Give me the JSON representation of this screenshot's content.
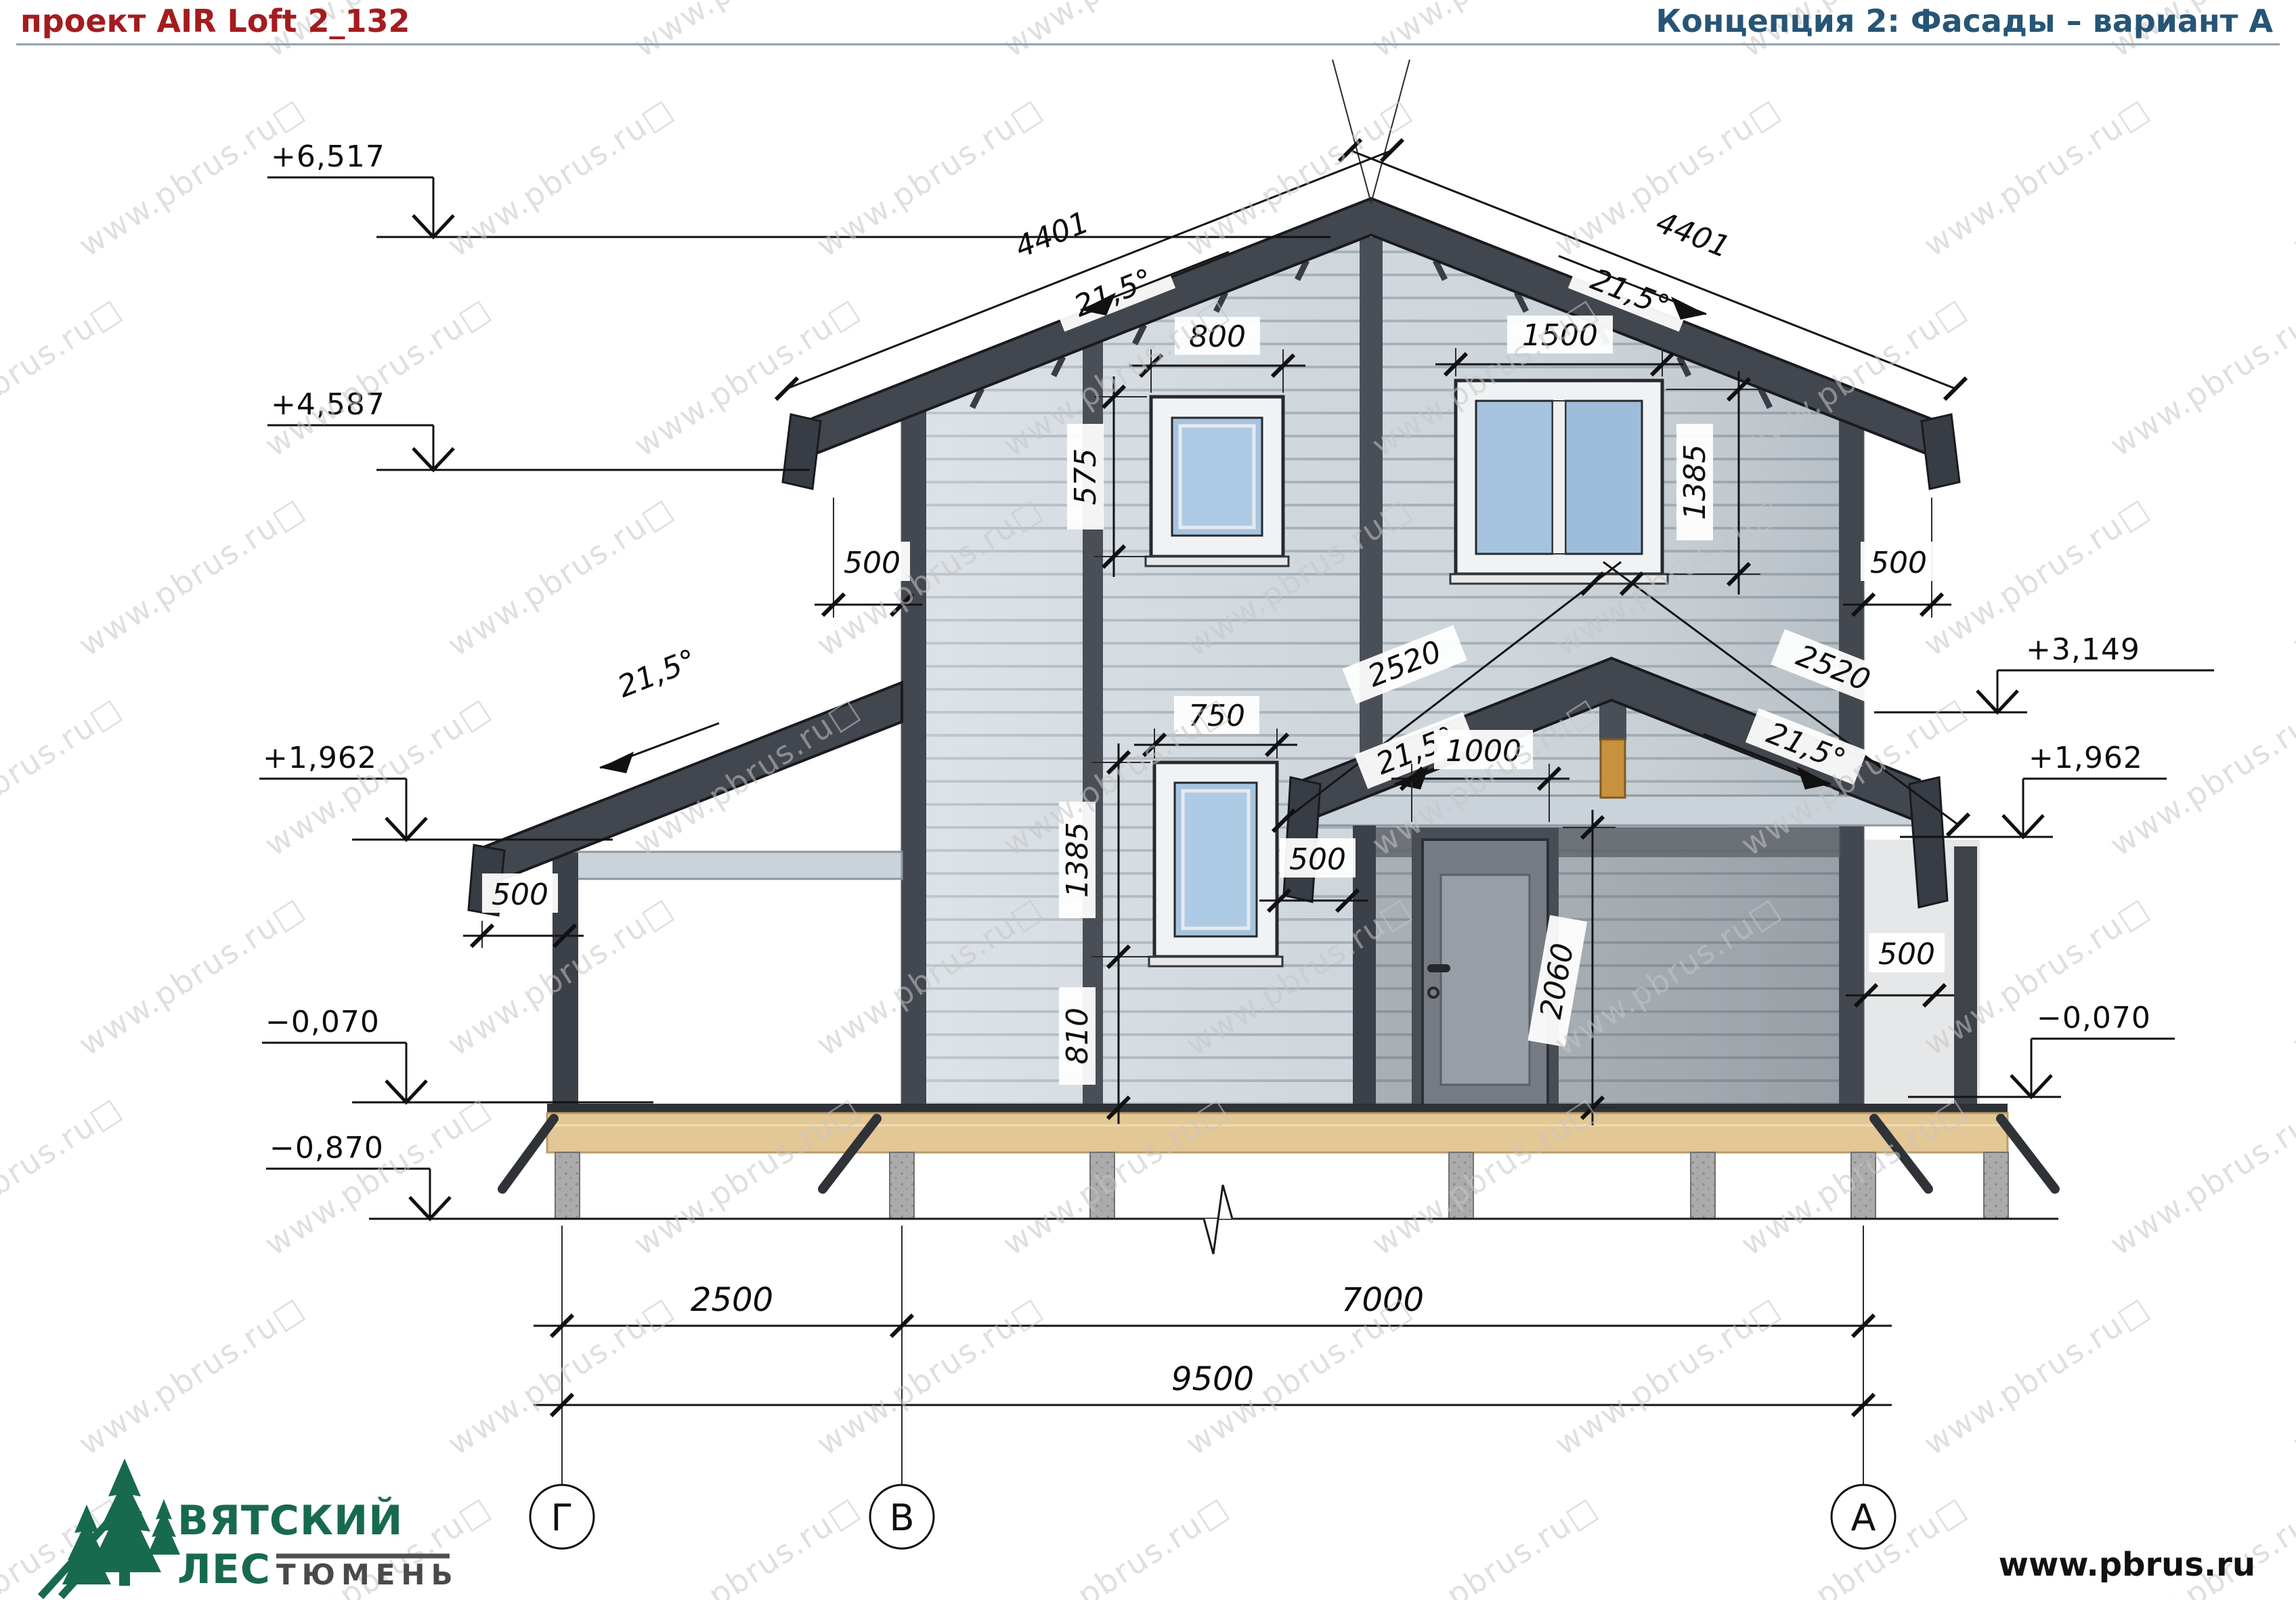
{
  "header": {
    "project_title": "проект AIR Loft 2_132",
    "concept_title": "Концепция 2: Фасады – вариант А"
  },
  "watermark": {
    "text": "www.pbrus.ru",
    "box": "□"
  },
  "levels": {
    "ridge": "+6,517",
    "eave": "+4,587",
    "porch": "+1,962",
    "floor": "−0,070",
    "ground": "−0,870",
    "canopy": "+3,149"
  },
  "dims": {
    "roof_slope_len": "4401",
    "roof_angle": "21,5°",
    "win_small_w": "800",
    "win_small_h": "575",
    "win_big_w": "1500",
    "win_big_h": "1385",
    "win_low_w": "750",
    "win_low_sill": "810",
    "door_w": "1000",
    "door_h": "2060",
    "overhang": "500",
    "porch_slope_len": "2520",
    "span_gv": "2500",
    "span_va": "7000",
    "span_total": "9500"
  },
  "axes": {
    "left": "Г",
    "mid": "В",
    "right": "А"
  },
  "footer": {
    "website": "www.pbrus.ru",
    "logo_word1": "ВЯТСКИЙ",
    "logo_word2": "ЛЕС",
    "logo_word3": "ТЮМЕНЬ"
  },
  "colors": {
    "accent_red": "#a31c1f",
    "title_blue": "#265575",
    "logo_green": "#186a4f",
    "roof_dark": "#42464e",
    "siding": "#cfd7dd",
    "glass": "#a6c4df",
    "deck_tan": "#e3c795"
  }
}
